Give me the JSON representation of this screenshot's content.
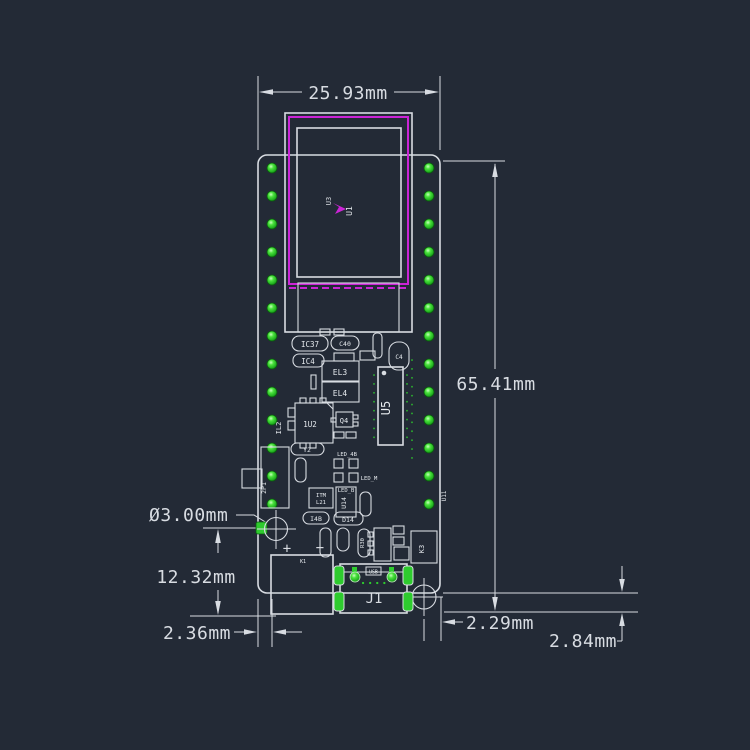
{
  "title": "PCB dimensional CAD drawing",
  "colors": {
    "background": "#232a36",
    "line": "#d8dce2",
    "magenta": "#cb24d6",
    "pin_green": "#2ecb2e",
    "green_text": "#3ed63e"
  },
  "dimensions": {
    "board_width": "25.93mm",
    "board_height": "65.41mm",
    "hole_diameter": "Ø3.00mm",
    "hole_to_bottom": "12.32mm",
    "left_edge_gap": "2.36mm",
    "right_edge_gap": "2.29mm",
    "usb_overhang": "2.84mm"
  },
  "labels": {
    "u1": "U1",
    "u3": "U3",
    "il2": "IL2",
    "ic37": "IC37",
    "ic4": "IC4",
    "c40": "C40",
    "el3": "EL3",
    "el4": "EL4",
    "u2": "1U2",
    "q4": "Q4",
    "u5": "U5",
    "c4": "C4",
    "y2": "Y2",
    "led_4b": "LED_4B",
    "led_m": "LED_M",
    "led_b": "LED_B",
    "itm": "ITM",
    "l21": "L21",
    "u14": "U14",
    "i4b": "I4B",
    "d14": "D14",
    "r30": "R30",
    "k3": "K3",
    "k1": "K1",
    "p1": "2P1",
    "u11": "U11",
    "j1": "J1",
    "usb": "USB",
    "plus": "+",
    "minus": "−"
  }
}
